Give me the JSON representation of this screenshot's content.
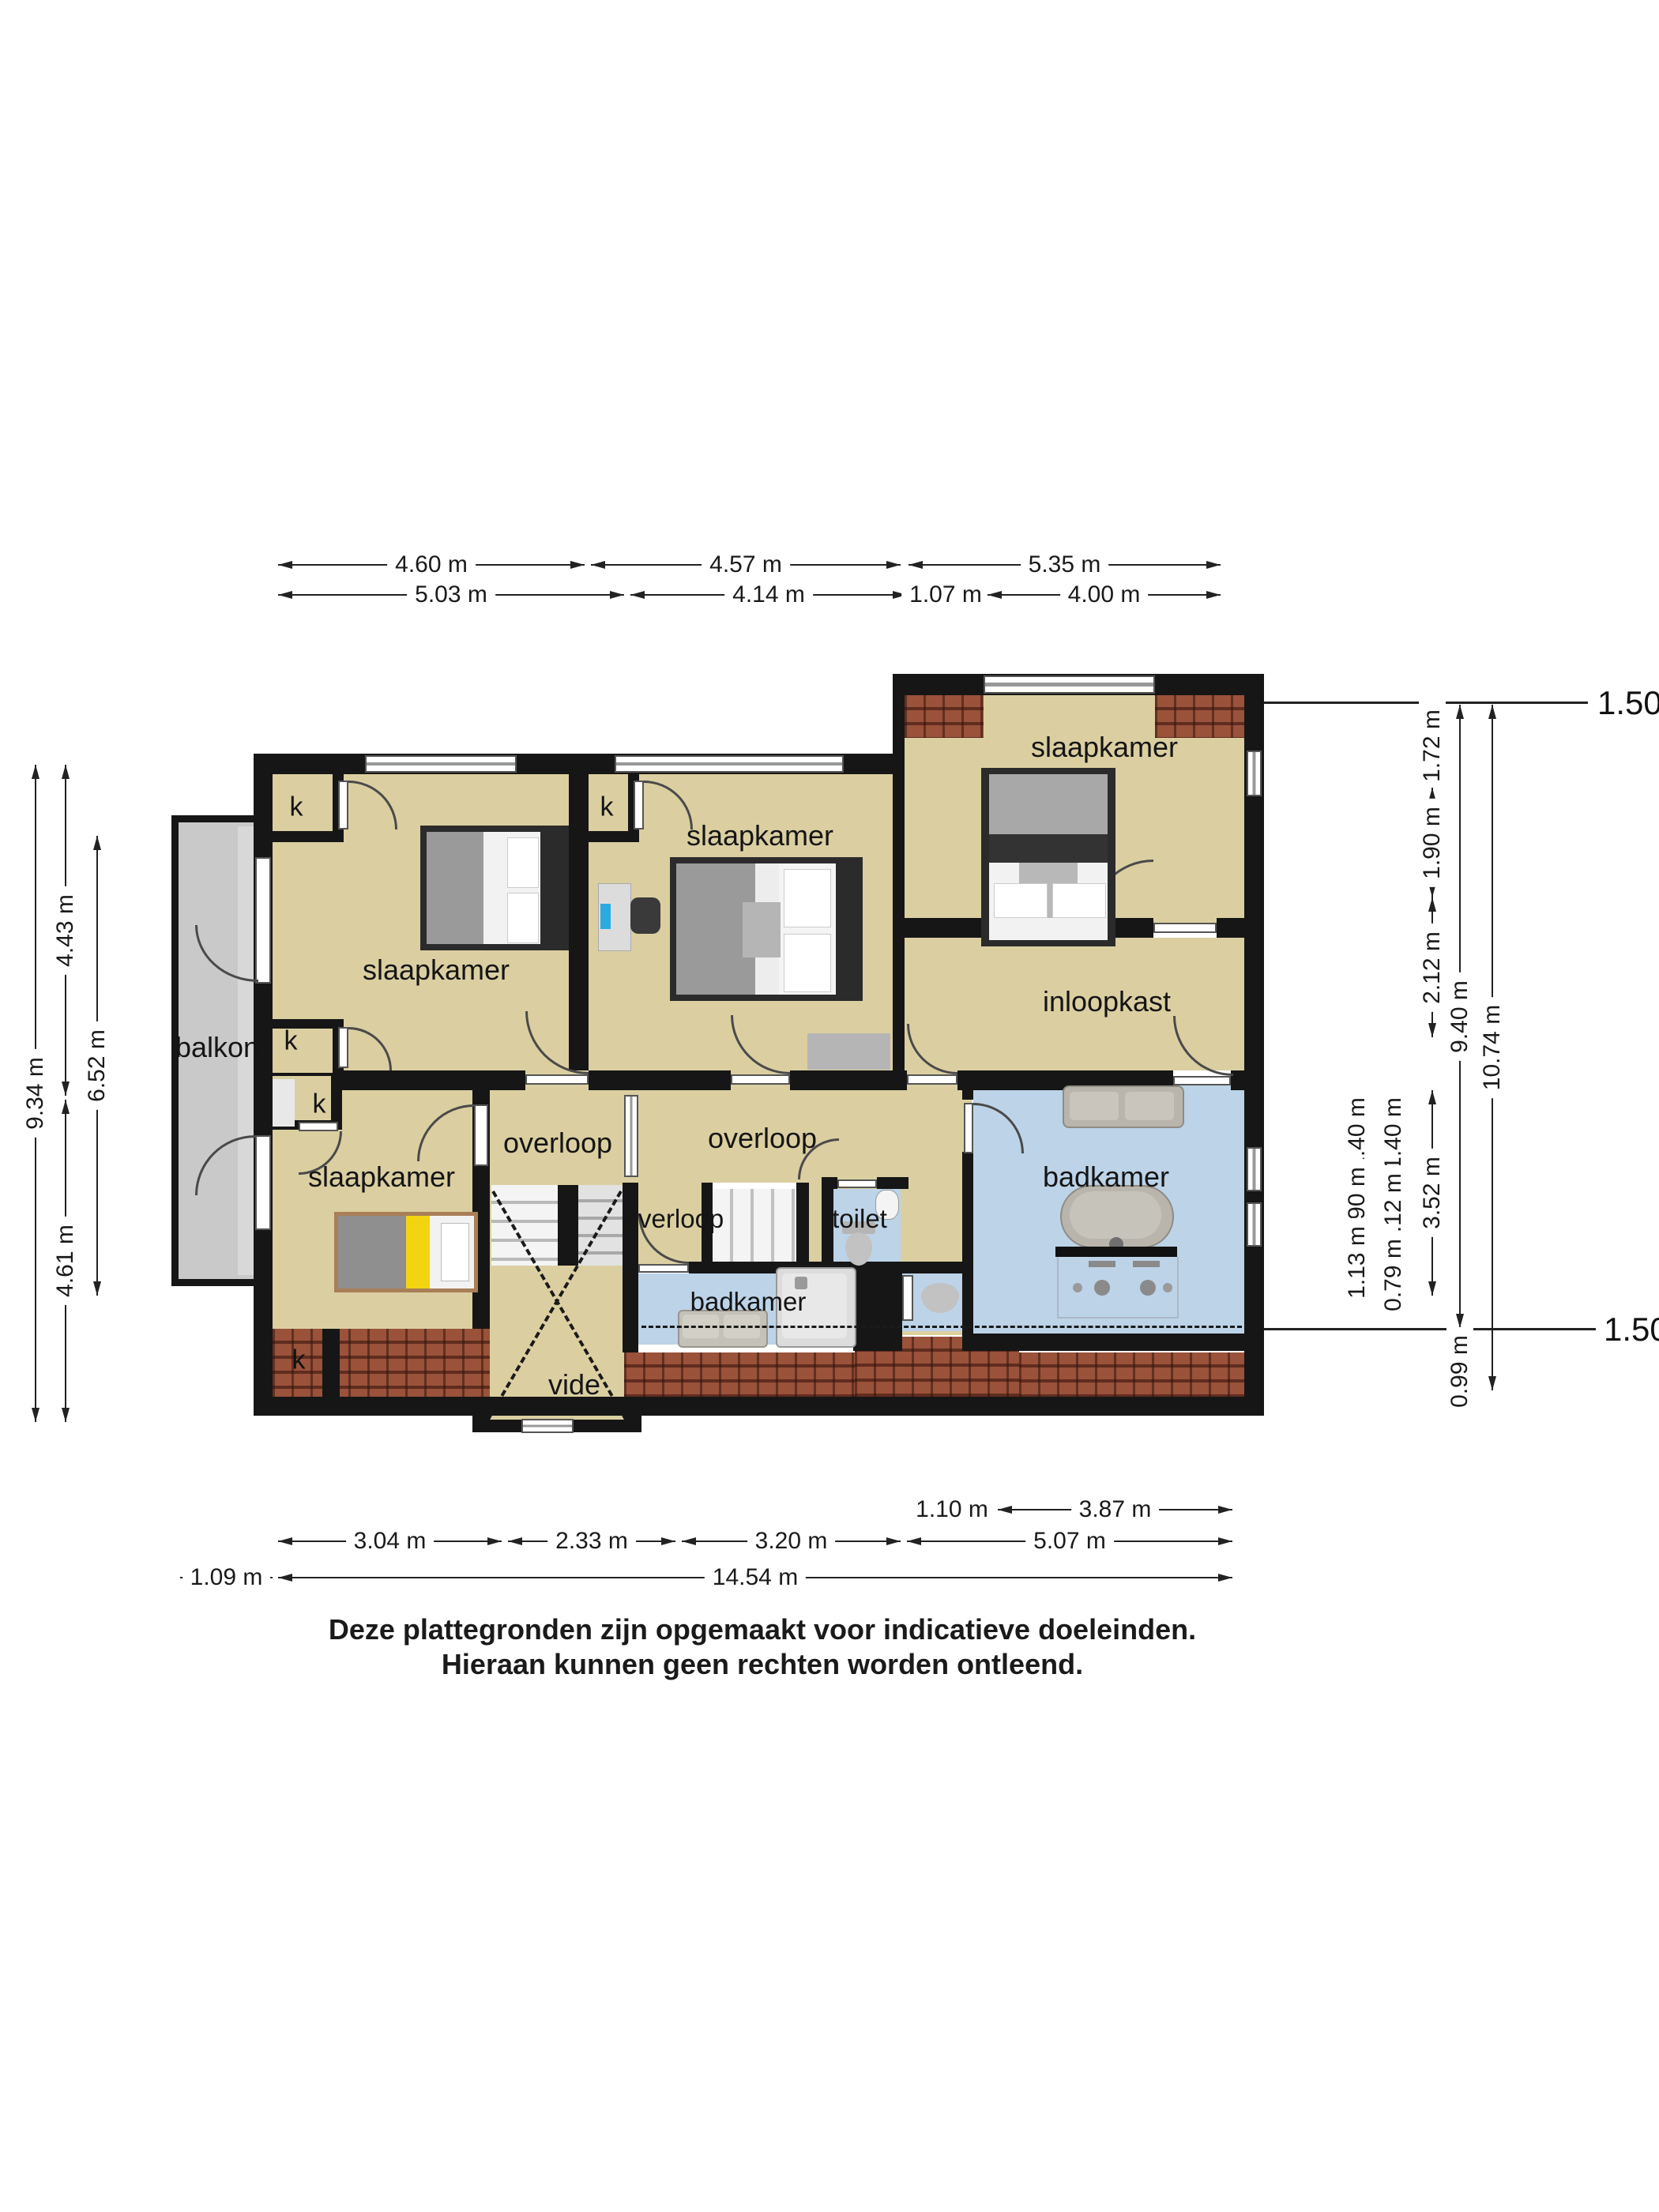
{
  "labels": {
    "bedroom_tl": "slaapkamer",
    "bedroom_mid": "slaapkamer",
    "bedroom_tr": "slaapkamer",
    "bedroom_bl": "slaapkamer",
    "balcony": "balkon",
    "walk_in_closet": "inloopkast",
    "landing_left": "overloop",
    "landing_main": "overloop",
    "landing_small": "overloop",
    "toilet": "toilet",
    "bathroom_main": "badkamer",
    "bathroom_small": "badkamer",
    "void": "vide",
    "closet": "k"
  },
  "dimensions": {
    "top_row1": [
      "4.60 m",
      "4.57 m",
      "5.35 m"
    ],
    "top_row2": [
      "5.03 m",
      "4.14 m",
      "1.07 m",
      "4.00 m"
    ],
    "bottom_row1": [
      "1.10 m",
      "3.87 m"
    ],
    "bottom_row2": [
      "3.04 m",
      "2.33 m",
      "3.20 m",
      "5.07 m"
    ],
    "bottom_row3": [
      "1.09 m",
      "14.54 m"
    ],
    "left": [
      "9.34 m",
      "4.43 m",
      "4.61 m",
      "6.52 m"
    ],
    "right_upper": [
      "1.72 m",
      "1.90 m",
      "2.12 m",
      "9.40 m",
      "10.74 m"
    ],
    "right_lower": [
      "1.40 m",
      "0.90 m",
      "1.13 m",
      "1.40 m",
      "1.12 m",
      "0.79 m",
      "3.52 m",
      "0.99 m"
    ],
    "height_line_top": "1.50m lijn",
    "height_line_bottom": "1.50m lijn"
  },
  "footer": {
    "line1": "Deze plattegronden zijn opgemaakt voor indicatieve doeleinden.",
    "line2": "Hieraan kunnen geen rechten worden ontleend."
  },
  "colors": {
    "room_tan": "#dbcfa1",
    "bathroom_blue": "#bcd3e8",
    "balcony_grey": "#c9c9c9",
    "roof_brick": "#98523b",
    "wall_black": "#161616",
    "laptop_blue": "#29abe2",
    "bed_yellow": "#f2d411"
  }
}
